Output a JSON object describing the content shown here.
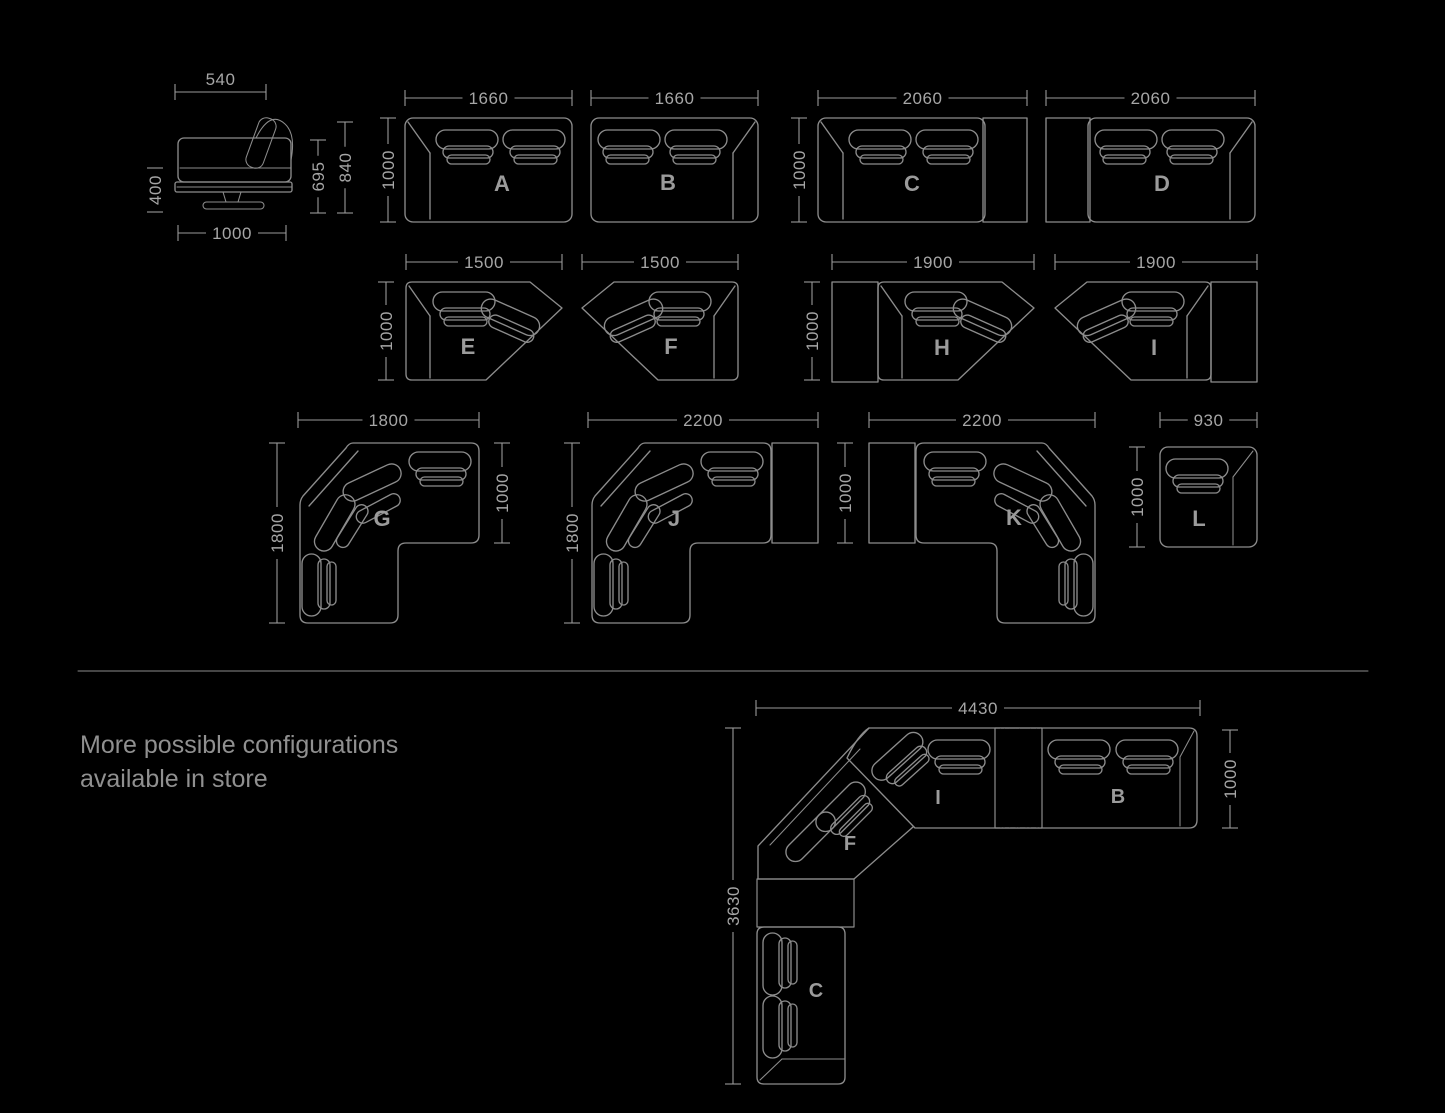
{
  "note": {
    "line1": "More possible configurations",
    "line2": "available in store"
  },
  "side_view": {
    "top_width": "540",
    "depth": "400",
    "seat_height": "695",
    "back_height": "840",
    "bottom_width": "1000"
  },
  "modules": {
    "a": {
      "label": "A",
      "width": "1660",
      "depth": "1000"
    },
    "b": {
      "label": "B",
      "width": "1660"
    },
    "c": {
      "label": "C",
      "width": "2060",
      "depth": "1000"
    },
    "d": {
      "label": "D",
      "width": "2060"
    },
    "e": {
      "label": "E",
      "width": "1500",
      "depth": "1000"
    },
    "f": {
      "label": "F",
      "width": "1500"
    },
    "h": {
      "label": "H",
      "width": "1900",
      "depth": "1000"
    },
    "i": {
      "label": "I",
      "width": "1900"
    },
    "g": {
      "label": "G",
      "width": "1800",
      "depth": "1800",
      "seat_depth": "1000"
    },
    "j": {
      "label": "J",
      "width": "2200",
      "depth": "1800",
      "seat_depth": "1000"
    },
    "k": {
      "label": "K",
      "width": "2200"
    },
    "l": {
      "label": "L",
      "width": "930",
      "depth": "1000"
    }
  },
  "configuration": {
    "total_width": "4430",
    "total_height": "3630",
    "depth": "1000",
    "module_labels": {
      "i": "I",
      "b": "B",
      "f": "F",
      "c": "C"
    }
  },
  "colors": {
    "background": "#000000",
    "line": "#8c8c8c",
    "grain": "#828282",
    "dim_line": "#9a9a9a",
    "dim_text": "#a6a6a6",
    "label_text": "#9b9b9b",
    "note_text": "#909090"
  }
}
